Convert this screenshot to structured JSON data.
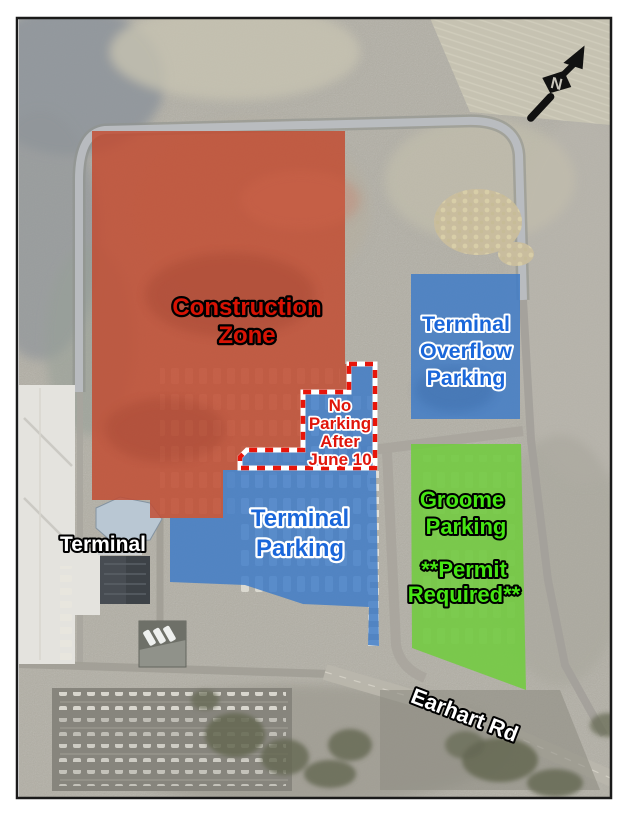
{
  "zones": {
    "construction": {
      "lines": [
        "Construction",
        "Zone"
      ],
      "fill": "#c2492e",
      "text_color": "#d81304"
    },
    "terminal_overflow": {
      "lines": [
        "Terminal",
        "Overflow",
        "Parking"
      ],
      "fill": "#3c7ac8",
      "text_color": "#1a67da"
    },
    "terminal_parking": {
      "lines": [
        "Terminal",
        "Parking"
      ],
      "fill": "#3c7ac8",
      "text_color": "#1a67da"
    },
    "no_parking": {
      "lines": [
        "No",
        "Parking",
        "After",
        "June 10"
      ],
      "fill": "#3c7ac8",
      "text_color": "#e0150a",
      "dash_color": "#e8150a"
    },
    "groome": {
      "lines": [
        "Groome",
        "Parking"
      ],
      "permit_lines": [
        "**Permit",
        "Required**"
      ],
      "fill": "#70cd3c",
      "text_color": "#46e513"
    }
  },
  "labels": {
    "terminal": "Terminal",
    "road": "Earhart Rd"
  },
  "compass": {
    "letter": "N"
  }
}
